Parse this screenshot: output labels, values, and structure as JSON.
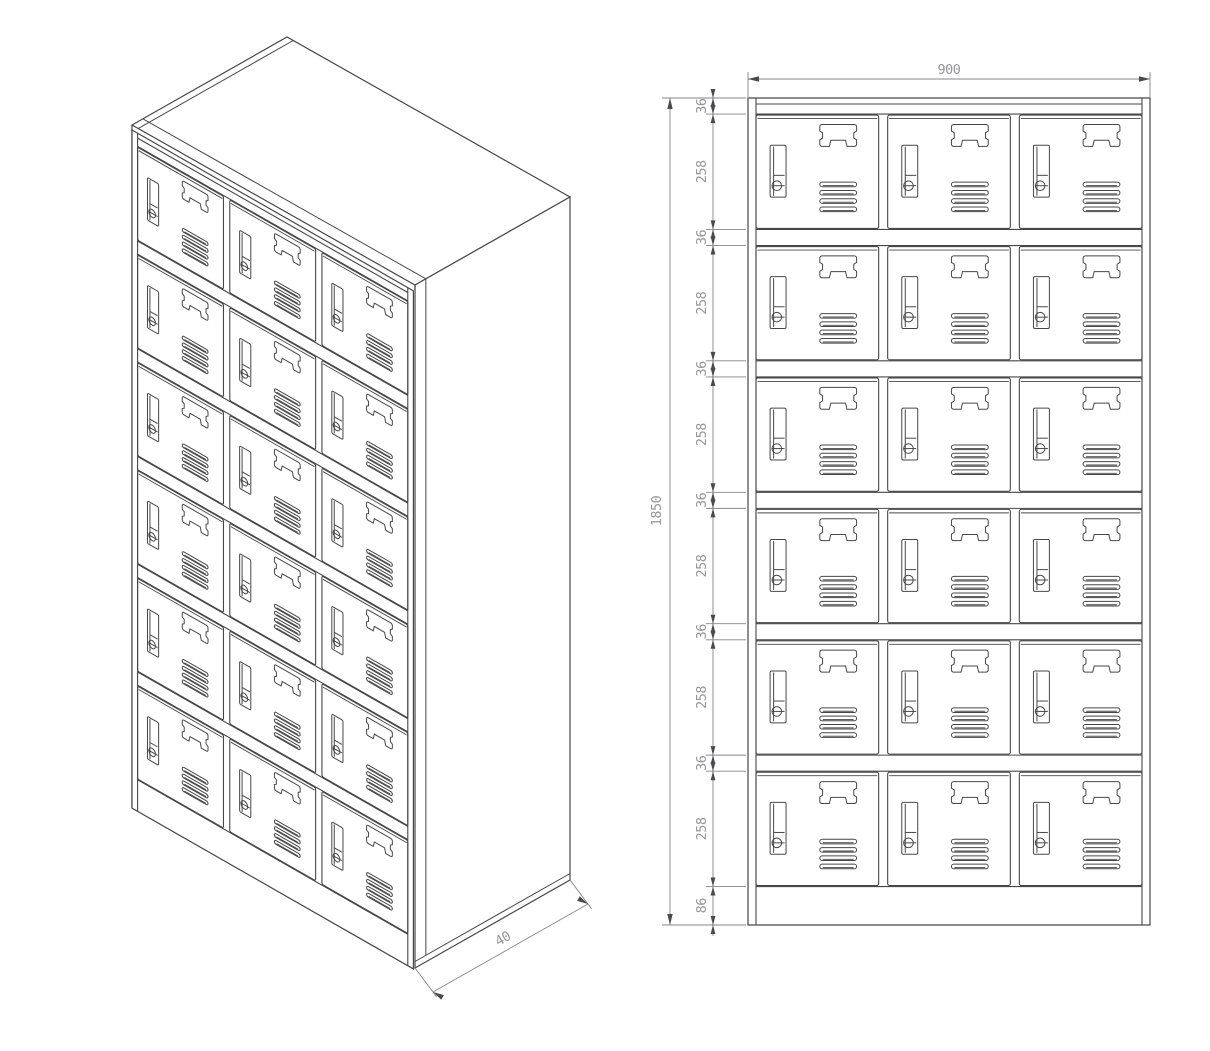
{
  "drawing": {
    "title": "locker-cabinet-technical-drawing",
    "background_color": "#ffffff",
    "line_color": "#474747",
    "dim_line_color": "#85858a",
    "dim_arrow_color": "#4a4a4e",
    "dim_text_color": "#95959a",
    "cabinet": {
      "rows": 6,
      "columns": 3,
      "door_count": 18,
      "door_features": [
        "lock-icon",
        "name-card-holder",
        "vent-grille"
      ]
    },
    "views": {
      "isometric": {
        "label": "isometric-view"
      },
      "front": {
        "label": "front-elevation-view"
      }
    },
    "dimensions": {
      "width_label": "900",
      "height_label": "1850",
      "depth_label": "40",
      "chain_segments": [
        "36",
        "258",
        "36",
        "258",
        "36",
        "258",
        "36",
        "258",
        "36",
        "258",
        "36",
        "258",
        "86"
      ]
    }
  }
}
